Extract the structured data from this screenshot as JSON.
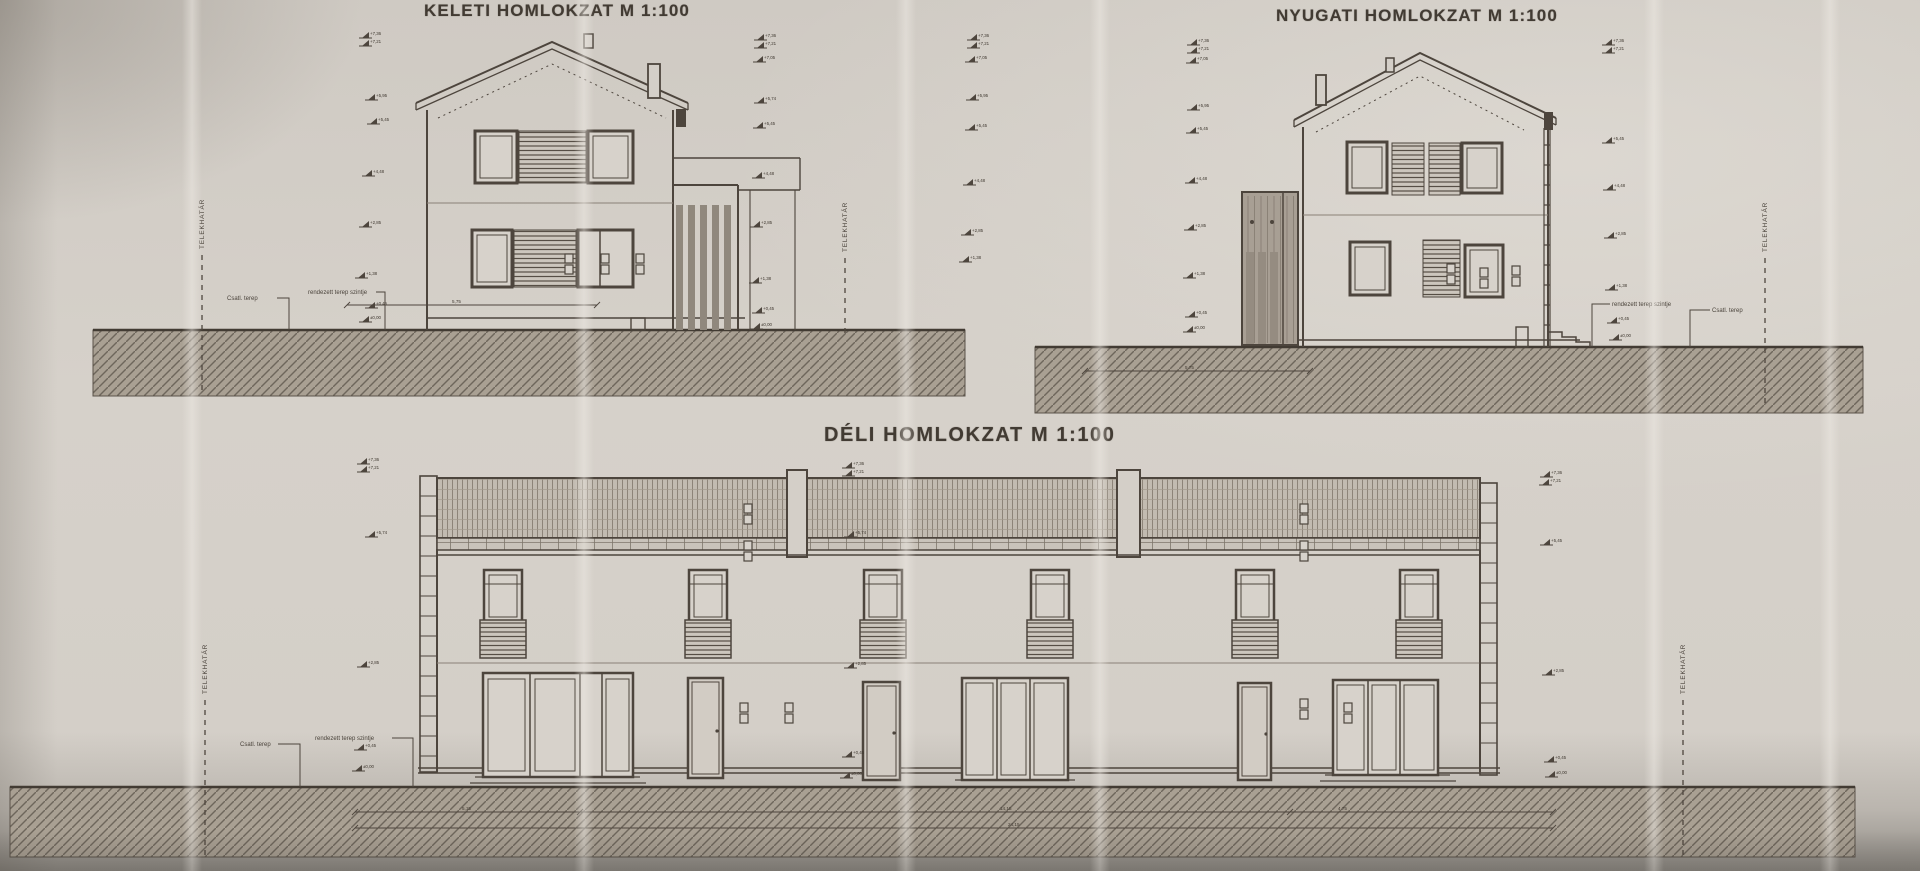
{
  "sheet": {
    "paper_color": "#d4cfc8",
    "ink_color": "#4d453d"
  },
  "drawings": {
    "keleti": {
      "title": "KELETI HOMLOKZAT M 1:100"
    },
    "nyugati": {
      "title": "NYUGATI HOMLOKZAT M 1:100"
    },
    "deli": {
      "title": "DÉLI HOMLOKZAT M 1:100"
    }
  },
  "labels": {
    "property_line": "TELEKHATÁR",
    "terrain_existing": "Csatl. terep",
    "terrain_planned": "rendezett terep szintje"
  },
  "elevation_markers": [
    {
      "group": "keleti-left",
      "x": 362,
      "y": 38,
      "value": "+7,36"
    },
    {
      "group": "keleti-left",
      "x": 362,
      "y": 46,
      "value": "+7,21"
    },
    {
      "group": "keleti-left",
      "x": 368,
      "y": 100,
      "value": "+5,95"
    },
    {
      "group": "keleti-left",
      "x": 370,
      "y": 124,
      "value": "+5,45"
    },
    {
      "group": "keleti-left",
      "x": 365,
      "y": 176,
      "value": "+4,48"
    },
    {
      "group": "keleti-left",
      "x": 362,
      "y": 227,
      "value": "+2,85"
    },
    {
      "group": "keleti-left",
      "x": 358,
      "y": 278,
      "value": "+1,38"
    },
    {
      "group": "keleti-left",
      "x": 368,
      "y": 308,
      "value": "+0,45"
    },
    {
      "group": "keleti-left",
      "x": 362,
      "y": 322,
      "value": "±0,00"
    },
    {
      "group": "keleti-right",
      "x": 757,
      "y": 40,
      "value": "+7,36"
    },
    {
      "group": "keleti-right",
      "x": 757,
      "y": 48,
      "value": "+7,21"
    },
    {
      "group": "keleti-right",
      "x": 756,
      "y": 62,
      "value": "+7,05"
    },
    {
      "group": "keleti-right",
      "x": 757,
      "y": 103,
      "value": "+5,74"
    },
    {
      "group": "keleti-right",
      "x": 756,
      "y": 128,
      "value": "+5,45"
    },
    {
      "group": "keleti-right",
      "x": 755,
      "y": 178,
      "value": "+4,48"
    },
    {
      "group": "keleti-right",
      "x": 753,
      "y": 227,
      "value": "+2,85"
    },
    {
      "group": "keleti-right",
      "x": 752,
      "y": 283,
      "value": "+1,38"
    },
    {
      "group": "keleti-right",
      "x": 755,
      "y": 313,
      "value": "+0,45"
    },
    {
      "group": "keleti-right",
      "x": 753,
      "y": 329,
      "value": "±0,00"
    },
    {
      "group": "nyugati-far-left",
      "x": 970,
      "y": 40,
      "value": "+7,36"
    },
    {
      "group": "nyugati-far-left",
      "x": 970,
      "y": 48,
      "value": "+7,21"
    },
    {
      "group": "nyugati-far-left",
      "x": 968,
      "y": 62,
      "value": "+7,05"
    },
    {
      "group": "nyugati-far-left",
      "x": 969,
      "y": 100,
      "value": "+5,95"
    },
    {
      "group": "nyugati-far-left",
      "x": 968,
      "y": 130,
      "value": "+5,45"
    },
    {
      "group": "nyugati-far-left",
      "x": 966,
      "y": 185,
      "value": "+4,48"
    },
    {
      "group": "nyugati-far-left",
      "x": 964,
      "y": 235,
      "value": "+2,85"
    },
    {
      "group": "nyugati-far-left",
      "x": 962,
      "y": 262,
      "value": "+1,38"
    },
    {
      "group": "nyugati-left",
      "x": 1190,
      "y": 45,
      "value": "+7,36"
    },
    {
      "group": "nyugati-left",
      "x": 1190,
      "y": 53,
      "value": "+7,21"
    },
    {
      "group": "nyugati-left",
      "x": 1189,
      "y": 63,
      "value": "+7,05"
    },
    {
      "group": "nyugati-left",
      "x": 1190,
      "y": 110,
      "value": "+5,95"
    },
    {
      "group": "nyugati-left",
      "x": 1189,
      "y": 133,
      "value": "+5,45"
    },
    {
      "group": "nyugati-left",
      "x": 1188,
      "y": 183,
      "value": "+4,48"
    },
    {
      "group": "nyugati-left",
      "x": 1187,
      "y": 230,
      "value": "+2,85"
    },
    {
      "group": "nyugati-left",
      "x": 1186,
      "y": 278,
      "value": "+1,38"
    },
    {
      "group": "nyugati-left",
      "x": 1188,
      "y": 317,
      "value": "+0,45"
    },
    {
      "group": "nyugati-left",
      "x": 1186,
      "y": 332,
      "value": "±0,00"
    },
    {
      "group": "nyugati-right",
      "x": 1605,
      "y": 45,
      "value": "+7,36"
    },
    {
      "group": "nyugati-right",
      "x": 1605,
      "y": 53,
      "value": "+7,21"
    },
    {
      "group": "nyugati-right",
      "x": 1605,
      "y": 143,
      "value": "+5,45"
    },
    {
      "group": "nyugati-right",
      "x": 1606,
      "y": 190,
      "value": "+4,48"
    },
    {
      "group": "nyugati-right",
      "x": 1607,
      "y": 238,
      "value": "+2,85"
    },
    {
      "group": "nyugati-right",
      "x": 1608,
      "y": 290,
      "value": "+1,38"
    },
    {
      "group": "nyugati-right",
      "x": 1610,
      "y": 323,
      "value": "+0,45"
    },
    {
      "group": "nyugati-right",
      "x": 1612,
      "y": 340,
      "value": "±0,00"
    },
    {
      "group": "deli-left",
      "x": 360,
      "y": 464,
      "value": "+7,36"
    },
    {
      "group": "deli-left",
      "x": 360,
      "y": 472,
      "value": "+7,21"
    },
    {
      "group": "deli-left",
      "x": 368,
      "y": 537,
      "value": "+5,74"
    },
    {
      "group": "deli-left",
      "x": 360,
      "y": 667,
      "value": "+2,85"
    },
    {
      "group": "deli-left",
      "x": 357,
      "y": 750,
      "value": "+0,45"
    },
    {
      "group": "deli-left",
      "x": 355,
      "y": 771,
      "value": "±0,00"
    },
    {
      "group": "deli-center",
      "x": 845,
      "y": 468,
      "value": "+7,36"
    },
    {
      "group": "deli-center",
      "x": 845,
      "y": 476,
      "value": "+7,21"
    },
    {
      "group": "deli-center",
      "x": 847,
      "y": 537,
      "value": "+5,74"
    },
    {
      "group": "deli-center",
      "x": 847,
      "y": 668,
      "value": "+2,85"
    },
    {
      "group": "deli-center",
      "x": 845,
      "y": 757,
      "value": "+0,45"
    },
    {
      "group": "deli-center",
      "x": 843,
      "y": 778,
      "value": "±0,00"
    },
    {
      "group": "deli-right",
      "x": 1543,
      "y": 477,
      "value": "+7,36"
    },
    {
      "group": "deli-right",
      "x": 1542,
      "y": 485,
      "value": "+7,21"
    },
    {
      "group": "deli-right",
      "x": 1543,
      "y": 545,
      "value": "+5,45"
    },
    {
      "group": "deli-right",
      "x": 1545,
      "y": 675,
      "value": "+2,85"
    },
    {
      "group": "deli-right",
      "x": 1547,
      "y": 762,
      "value": "+0,45"
    },
    {
      "group": "deli-right",
      "x": 1548,
      "y": 777,
      "value": "±0,00"
    }
  ],
  "property_lines": [
    {
      "x": 202,
      "y1": 255,
      "y2": 392,
      "label_y": 249
    },
    {
      "x": 845,
      "y1": 258,
      "y2": 338,
      "label_y": 252
    },
    {
      "x": 1765,
      "y1": 258,
      "y2": 408,
      "label_y": 252
    },
    {
      "x": 205,
      "y1": 700,
      "y2": 855,
      "label_y": 694
    },
    {
      "x": 1683,
      "y1": 700,
      "y2": 855,
      "label_y": 694
    }
  ],
  "terrain_labels": [
    {
      "key": "terrain_existing",
      "x": 227,
      "y": 300,
      "lx": 277,
      "bx": 289,
      "gy": 330
    },
    {
      "key": "terrain_planned",
      "x": 308,
      "y": 294,
      "lx": 376,
      "bx": 385,
      "gy": 330
    },
    {
      "key": "terrain_planned",
      "x": 1612,
      "y": 306,
      "lx": 1610,
      "bx": 1592,
      "gy": 347
    },
    {
      "key": "terrain_existing",
      "x": 1712,
      "y": 312,
      "lx": 1710,
      "bx": 1690,
      "gy": 347
    },
    {
      "key": "terrain_existing",
      "x": 240,
      "y": 746,
      "lx": 278,
      "bx": 300,
      "gy": 787
    },
    {
      "key": "terrain_planned",
      "x": 315,
      "y": 740,
      "lx": 392,
      "bx": 413,
      "gy": 787
    }
  ],
  "dimension_lines": [
    {
      "x1": 347,
      "x2": 597,
      "y": 305,
      "ticks": [
        347,
        597
      ],
      "labels": [
        {
          "x": 452,
          "t": "5,75"
        }
      ]
    },
    {
      "x1": 1085,
      "x2": 1310,
      "y": 371,
      "ticks": [
        1085,
        1310
      ],
      "labels": [
        {
          "x": 1185,
          "t": "5,75"
        }
      ]
    },
    {
      "x1": 355,
      "x2": 1553,
      "y": 812,
      "ticks": [
        355,
        580,
        1290,
        1553
      ],
      "labels": [
        {
          "x": 462,
          "t": "5,15"
        },
        {
          "x": 1000,
          "t": "14,15"
        },
        {
          "x": 1338,
          "t": "4,75"
        }
      ]
    },
    {
      "x1": 355,
      "x2": 1553,
      "y": 828,
      "ticks": [
        355,
        1553
      ],
      "labels": [
        {
          "x": 1008,
          "t": "24,15"
        }
      ]
    }
  ]
}
